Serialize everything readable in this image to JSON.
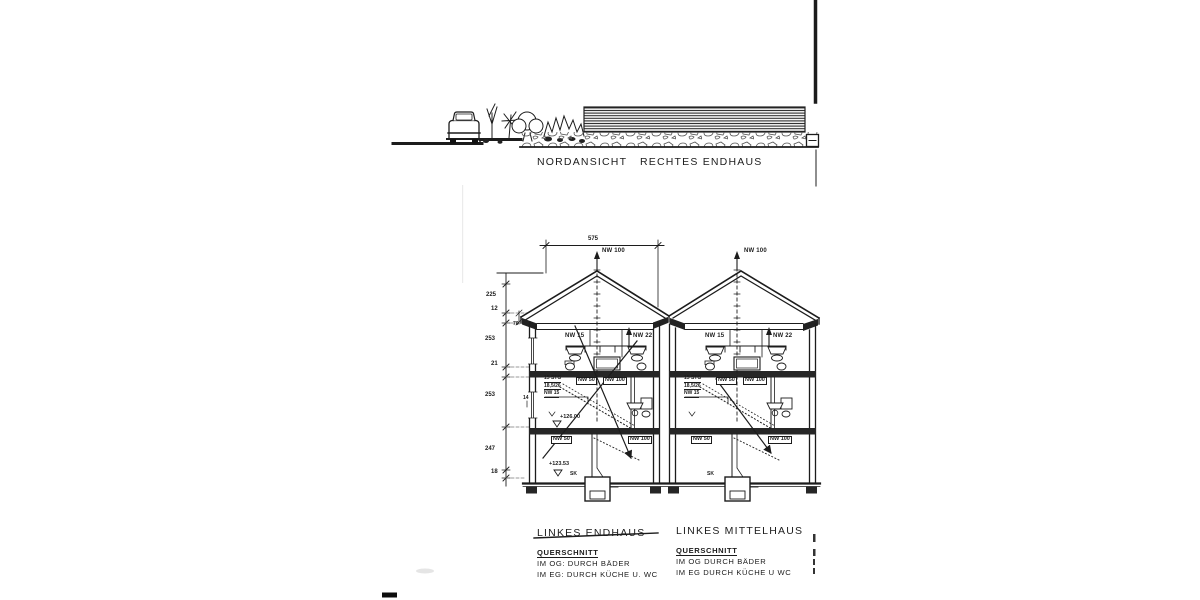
{
  "elevation": {
    "view": "NORDANSICHT",
    "building": "RECHTES ENDHAUS"
  },
  "dims": {
    "width_top": "575",
    "roof_height": "225",
    "slab_top": "12",
    "knee": "70",
    "og_height": "253",
    "slab_mid": "21",
    "eg_height": "253",
    "kg_height": "247",
    "footing": "18",
    "wall": "14"
  },
  "pipes": {
    "vent": "NW 100",
    "wash": "NW 15",
    "wc": "NW 22",
    "drain50": "NW 50",
    "drain100": "NW 100"
  },
  "stair": {
    "l1": "15 STG",
    "l2": "18,5/26",
    "l3": "NW 15"
  },
  "levels": {
    "eg": "+126.00",
    "kg": "+123.53",
    "sk": "SK"
  },
  "captions": {
    "left": {
      "title": "LINKES ENDHAUS",
      "sub": "QUERSCHNITT",
      "line1": "IM OG:  DURCH  BÄDER",
      "line2": "IM EG:  DURCH  KÜCHE U. WC"
    },
    "mid": {
      "title": "LINKES MITTELHAUS",
      "sub": "QUERSCHNITT",
      "line1": "IM OG   DURCH  BÄDER",
      "line2": "IM EG   DURCH  KÜCHE U  WC"
    }
  }
}
